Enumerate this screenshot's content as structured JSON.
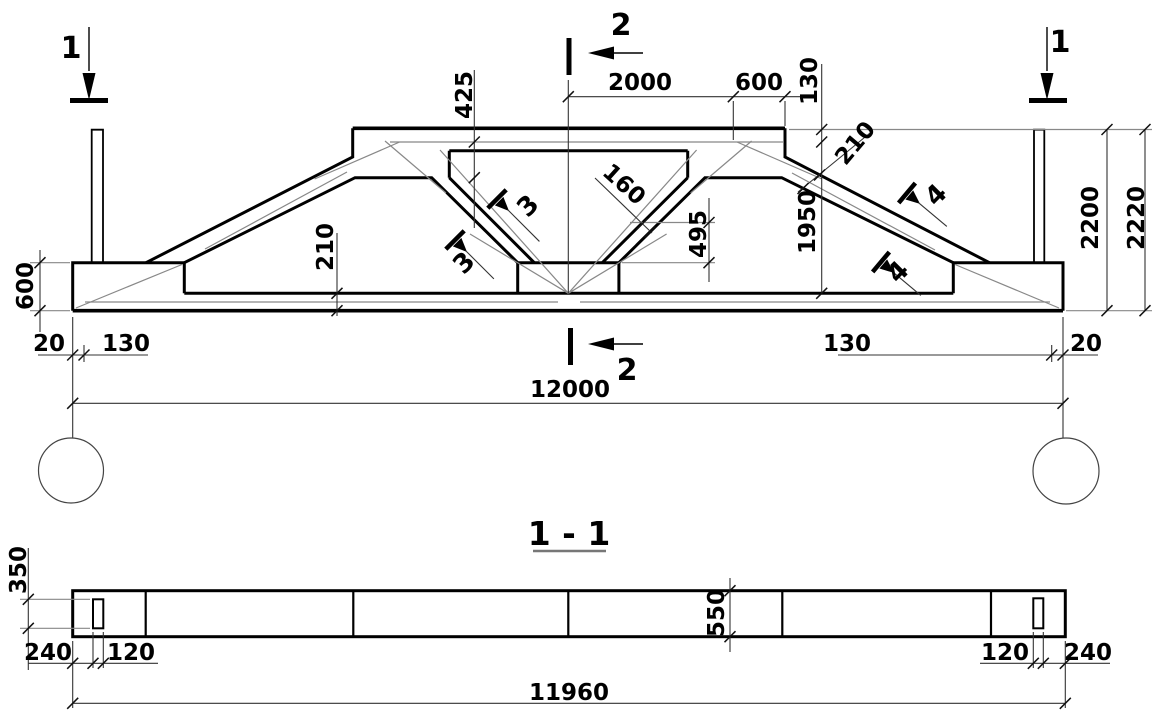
{
  "meta": {
    "drawing_type": "structural truss elevation with section",
    "background": "#ffffff",
    "line_color": "#000000",
    "thin_line_color": "#808080"
  },
  "elevation": {
    "section_marks": {
      "one": "1",
      "two": "2",
      "three": "3",
      "four": "4"
    },
    "dims": {
      "span": "12000",
      "top_2000": "2000",
      "top_600": "600",
      "top_130": "130",
      "v425": "425",
      "v1950": "1950",
      "v2200": "2200",
      "v2220": "2220",
      "left_600": "600",
      "edge_20": "20",
      "edge_130": "130",
      "bc_210": "210",
      "chord_210": "210",
      "strut_160": "160",
      "v495": "495"
    }
  },
  "section_1_1": {
    "title": "1 - 1",
    "dims": {
      "length": "11960",
      "height_550": "550",
      "hole_350": "350",
      "end_240": "240",
      "hole_120": "120"
    }
  }
}
